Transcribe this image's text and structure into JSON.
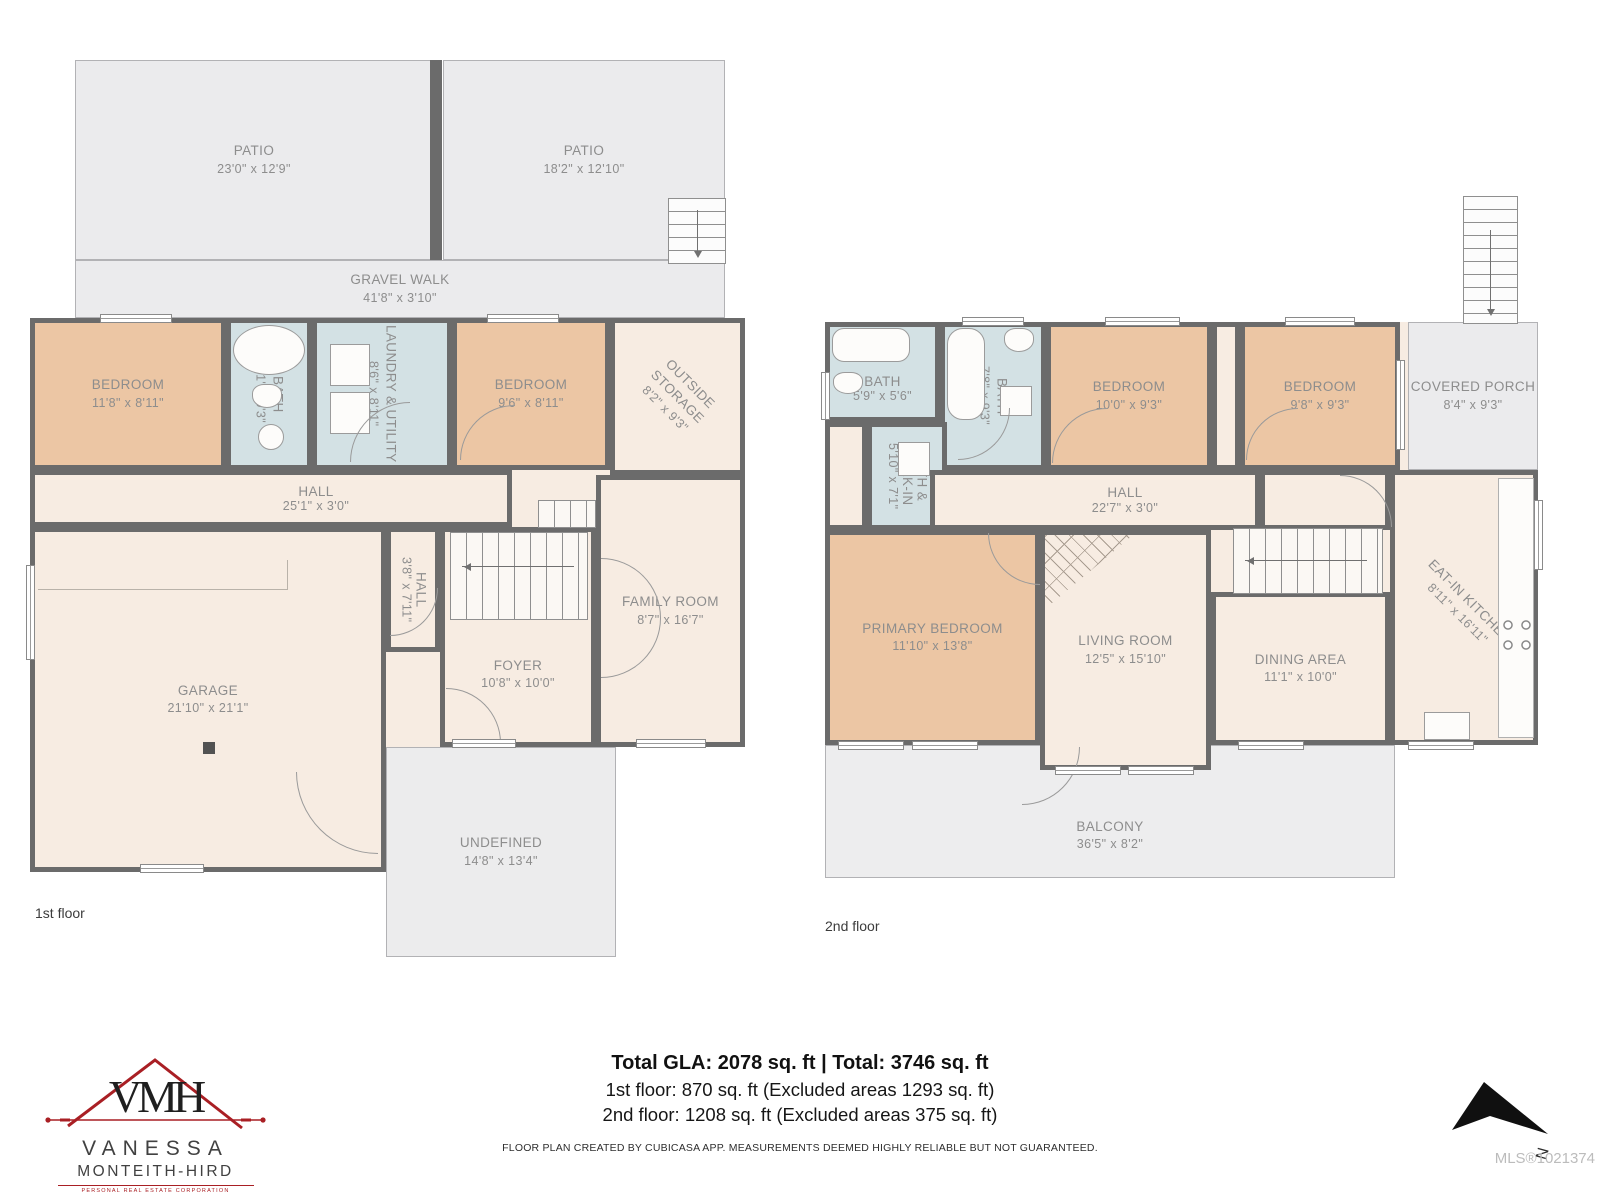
{
  "meta": {
    "floor1_label": "1st floor",
    "floor2_label": "2nd floor",
    "mls": "MLS®1021374",
    "north_label": "N"
  },
  "branding": {
    "monogram": "VMH",
    "name_line1": "VANESSA",
    "name_line2": "MONTEITH-HIRD",
    "tagline": "PERSONAL REAL ESTATE CORPORATION"
  },
  "summary": {
    "line1": "Total GLA: 2078 sq. ft | Total: 3746 sq. ft",
    "line2": "1st floor: 870 sq. ft (Excluded areas 1293 sq. ft)",
    "line3": "2nd floor: 1208 sq. ft (Excluded areas 375 sq. ft)",
    "disclaimer": "FLOOR PLAN CREATED BY CUBICASA APP. MEASUREMENTS DEEMED HIGHLY RELIABLE BUT NOT GUARANTEED."
  },
  "colors": {
    "wall": "#6b6b6b",
    "room_cream": "#f7ece2",
    "room_tan": "#ecc6a4",
    "room_blue": "#d3e1e4",
    "outdoor_gray": "#ebebed",
    "label_gray": "#8d8d8d",
    "logo_red": "#a91f24"
  },
  "floor1": {
    "patio_left": {
      "name": "PATIO",
      "dims": "23'0\" x 12'9\""
    },
    "patio_right": {
      "name": "PATIO",
      "dims": "18'2\" x 12'10\""
    },
    "gravel_walk": {
      "name": "GRAVEL WALK",
      "dims": "41'8\" x 3'10\""
    },
    "bedroom_left": {
      "name": "BEDROOM",
      "dims": "11'8\" x 8'11\""
    },
    "bath": {
      "name": "BATH",
      "dims": "5'1\" x 9'3\""
    },
    "laundry": {
      "name": "LAUNDRY & UTILITY",
      "dims": "8'6\" x 8'11\""
    },
    "bedroom_right": {
      "name": "BEDROOM",
      "dims": "9'6\" x 8'11\""
    },
    "outside_storage": {
      "name": "OUTSIDE STORAGE",
      "dims": "8'2\" x 9'3\""
    },
    "hall": {
      "name": "HALL",
      "dims": "25'1\" x 3'0\""
    },
    "hall_small": {
      "name": "HALL",
      "dims": "3'8\" x 7'11\""
    },
    "garage": {
      "name": "GARAGE",
      "dims": "21'10\" x 21'1\""
    },
    "foyer": {
      "name": "FOYER",
      "dims": "10'8\" x 10'0\""
    },
    "family_room": {
      "name": "FAMILY ROOM",
      "dims": "8'7\" x 16'7\""
    },
    "undefined_area": {
      "name": "UNDEFINED",
      "dims": "14'8\" x 13'4\""
    }
  },
  "floor2": {
    "bath_small": {
      "name": "BATH",
      "dims": "5'9\" x 5'6\""
    },
    "bath_main": {
      "name": "BATH",
      "dims": "7'8\" x 9'3\""
    },
    "bedroom_mid": {
      "name": "BEDROOM",
      "dims": "10'0\" x 9'3\""
    },
    "bedroom_right": {
      "name": "BEDROOM",
      "dims": "9'8\" x 9'3\""
    },
    "covered_porch": {
      "name": "COVERED PORCH",
      "dims": "8'4\" x 9'3\""
    },
    "bath_walkin": {
      "name": "BATH & WALK-IN",
      "dims": "5'10\" x 7'1\""
    },
    "hall": {
      "name": "HALL",
      "dims": "22'7\" x 3'0\""
    },
    "primary_bedroom": {
      "name": "PRIMARY BEDROOM",
      "dims": "11'10\" x 13'8\""
    },
    "living_room": {
      "name": "LIVING ROOM",
      "dims": "12'5\" x 15'10\""
    },
    "dining_area": {
      "name": "DINING AREA",
      "dims": "11'1\" x 10'0\""
    },
    "kitchen": {
      "name": "EAT-IN KITCHEN",
      "dims": "8'11\" x 16'11\""
    },
    "balcony": {
      "name": "BALCONY",
      "dims": "36'5\" x 8'2\""
    }
  }
}
